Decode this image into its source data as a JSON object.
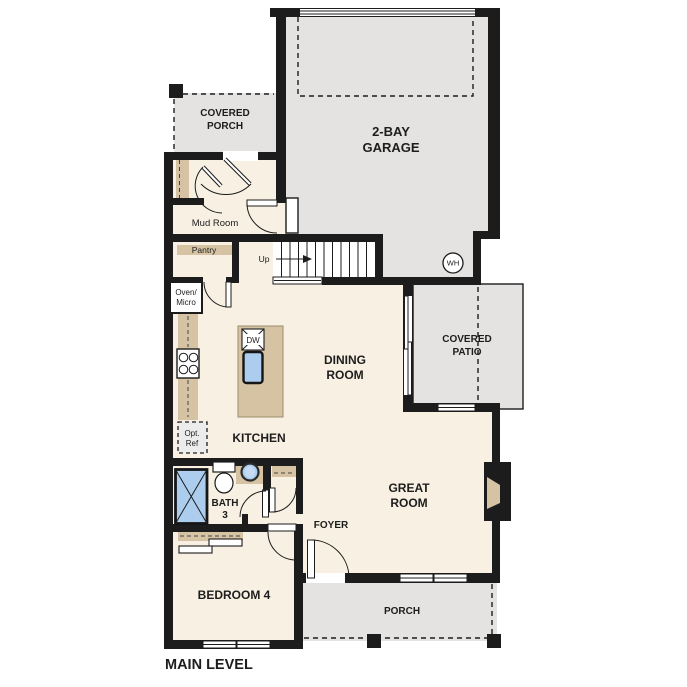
{
  "title": {
    "main_level": "MAIN LEVEL"
  },
  "colors": {
    "wall": "#1c1c1c",
    "floor": "#f8f0e2",
    "gray": "#e4e3e1",
    "tan": "#d5c3a4",
    "blue": "#accdee",
    "paper": "#ffffff",
    "ink": "#1d1d1d"
  },
  "rooms": {
    "covered_porch": {
      "l1": "COVERED",
      "l2": "PORCH"
    },
    "garage": {
      "l1": "2-BAY",
      "l2": "GARAGE"
    },
    "mud_room": {
      "l1": "Mud Room"
    },
    "pantry": {
      "l1": "Pantry"
    },
    "dining": {
      "l1": "DINING",
      "l2": "ROOM"
    },
    "covered_patio": {
      "l1": "COVERED",
      "l2": "PATIO"
    },
    "kitchen": {
      "l1": "KITCHEN"
    },
    "great_room": {
      "l1": "GREAT",
      "l2": "ROOM"
    },
    "bath3": {
      "l1": "BATH",
      "l2": "3"
    },
    "foyer": {
      "l1": "FOYER"
    },
    "bedroom4": {
      "l1": "BEDROOM 4"
    },
    "porch": {
      "l1": "PORCH"
    }
  },
  "fixtures": {
    "oven_micro": {
      "l1": "Oven/",
      "l2": "Micro"
    },
    "opt_ref": {
      "l1": "Opt.",
      "l2": "Ref"
    },
    "dishwasher": "DW",
    "water_heater": "WH",
    "stairs_up": "Up"
  }
}
